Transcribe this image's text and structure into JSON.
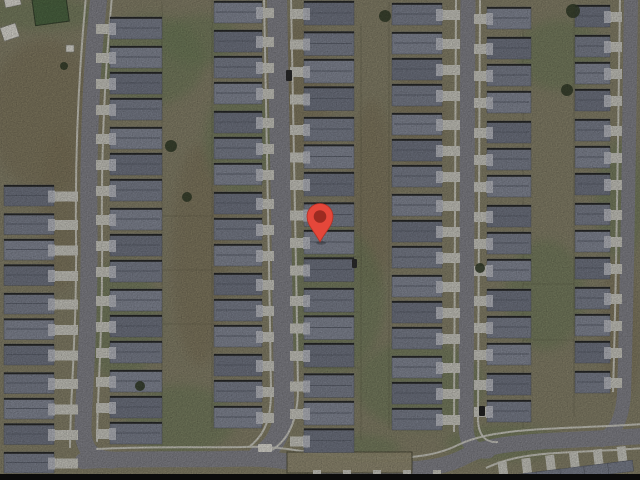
{
  "map": {
    "width": 640,
    "height": 480,
    "palette": {
      "ground": "#8f8a71",
      "dirt": "#867c61",
      "grass": "#75855e",
      "grass_dark": "#4e6b44",
      "road": "#8c8c93",
      "sidewalk": "#deddd4",
      "driveway": "#d7d6cd",
      "roof_shades": [
        "#787d8b",
        "#838896",
        "#8d92a0"
      ],
      "roof_stroke": "#5a5e68",
      "roof_eave": "#1e1e1c",
      "roof_ridge": "#656a77",
      "garage": "#c9cbd1",
      "fence": "#53523d",
      "tree": "#39432e",
      "white": "#eceae2",
      "bottom_bar": "#0b0b0b",
      "marker_fill": "#e5473a",
      "marker_stroke": "#b23226",
      "marker_hole": "#9c2b21"
    },
    "marker": {
      "x": 320,
      "center_y": 216.5,
      "tip_y": 242,
      "radius": 13,
      "hole_radius": 6.3
    },
    "streets": [
      {
        "name": "street-left",
        "width": 17,
        "path": "M 99 -4 C 92 60 88 140 89 225 C 90 320 84 390 83 428 C 83 450 92 459 112 460"
      },
      {
        "name": "street-center",
        "width": 20,
        "path": "M 277 -4 C 280 140 282 260 284 395 C 285 425 278 446 258 456"
      },
      {
        "name": "street-right",
        "width": 15,
        "path": "M 468 -4 L 466 425 C 466 444 474 452 488 451"
      },
      {
        "name": "street-far-right",
        "width": 14,
        "path": "M 631 -4 C 629 150 627 300 624 395 C 622 418 616 432 602 440"
      },
      {
        "name": "street-bottom",
        "width": 16,
        "path": "M 83 461 C 130 458 190 460 225 459 C 258 458 275 459 295 463 C 330 469 365 471 398 470 C 428 469 448 466 466 456 C 488 445 515 443 548 441 C 585 439 615 438 644 436"
      }
    ],
    "sidewalks": [
      "M 86 -4 C 79 70 75 150 76 235 C 77 330 70 400 70 448",
      "M 112 -4 C 105 70 101 150 102 235 C 103 330 97 400 97 442",
      "M 264 -4 C 267 140 269 260 271 392 C 271 416 266 434 250 446",
      "M 291 -4 C 294 140 296 260 298 388 C 298 416 291 438 272 450",
      "M 456 -4 L 454 432",
      "M 480 -4 L 478 418 C 478 436 486 443 498 442",
      "M 620 -4 C 618 150 616 300 613 392",
      "M 96 449 C 150 446 205 448 242 447 C 272 446 288 449 308 452 C 338 457 368 459 396 458 C 420 457 440 454 458 445 C 478 435 508 431 544 429 C 584 427 614 426 644 424",
      "M 486 468 C 505 459 525 455 556 453 C 592 451 620 450 644 448"
    ],
    "house_columns": [
      {
        "x": 4,
        "w": 52,
        "h": 21,
        "y0": 186,
        "step": 26.5,
        "count": 11,
        "side": "right",
        "drive_len": 24
      },
      {
        "x": 110,
        "w": 52,
        "h": 22,
        "y0": 18,
        "step": 27,
        "count": 16,
        "side": "left",
        "drive_len": 14
      },
      {
        "x": 214,
        "w": 46,
        "h": 22,
        "y0": 2,
        "step": 27,
        "count": 16,
        "side": "right",
        "drive_len": 12
      },
      {
        "x": 304,
        "w": 52,
        "h": 24,
        "y0": 2,
        "step": 28.5,
        "count": 16,
        "side": "left",
        "drive_len": 14
      },
      {
        "x": 392,
        "w": 50,
        "h": 22,
        "y0": 4,
        "step": 27,
        "count": 16,
        "side": "right",
        "drive_len": 18
      },
      {
        "x": 487,
        "w": 42,
        "h": 22,
        "y0": 8,
        "step": 28,
        "count": 15,
        "side": "left",
        "drive_len": 13
      },
      {
        "x": 575,
        "w": 37,
        "h": 22,
        "y0": 6,
        "step": 28,
        "count": 14,
        "side": "right",
        "drive_len": 12
      }
    ],
    "grass_patches": [
      [
        40,
        14,
        60,
        16
      ],
      [
        150,
        60,
        55,
        45
      ],
      [
        240,
        140,
        35,
        55
      ],
      [
        330,
        300,
        55,
        75
      ],
      [
        420,
        385,
        65,
        45
      ],
      [
        545,
        295,
        40,
        55
      ],
      [
        560,
        55,
        45,
        35
      ],
      [
        180,
        420,
        55,
        35
      ],
      [
        505,
        443,
        60,
        18
      ],
      [
        355,
        448,
        45,
        14
      ],
      [
        120,
        320,
        40,
        60
      ],
      [
        620,
        200,
        25,
        60
      ],
      [
        200,
        40,
        40,
        25
      ]
    ],
    "dirt_patches": [
      [
        45,
        115,
        55,
        75
      ],
      [
        200,
        255,
        28,
        110
      ],
      [
        372,
        195,
        22,
        95
      ],
      [
        300,
        90,
        30,
        70
      ],
      [
        620,
        330,
        20,
        70
      ],
      [
        60,
        210,
        20,
        80
      ],
      [
        420,
        120,
        25,
        60
      ]
    ],
    "fences_v": [
      [
        162,
        2,
        162,
        448
      ],
      [
        212,
        0,
        212,
        432
      ],
      [
        361,
        24,
        361,
        440
      ],
      [
        389,
        2,
        389,
        430
      ],
      [
        523,
        6,
        523,
        428
      ],
      [
        574,
        4,
        574,
        416
      ]
    ],
    "fences_h": [
      [
        160,
        216,
        214,
        216
      ],
      [
        160,
        270,
        214,
        270
      ],
      [
        160,
        324,
        214,
        324
      ],
      [
        305,
        257,
        360,
        257
      ],
      [
        305,
        312,
        360,
        312
      ],
      [
        305,
        368,
        360,
        368
      ],
      [
        523,
        284,
        574,
        284
      ],
      [
        523,
        340,
        574,
        340
      ],
      [
        390,
        260,
        440,
        260
      ],
      [
        390,
        368,
        440,
        368
      ]
    ],
    "green_square": {
      "x": 32,
      "y": 0,
      "w": 34,
      "h": 26
    },
    "sheds": [
      {
        "x": 4,
        "y": 0,
        "w": 16,
        "h": 8,
        "rot": -12
      },
      {
        "x": 0,
        "y": 28,
        "w": 16,
        "h": 14,
        "rot": -18
      },
      {
        "x": 66,
        "y": 45,
        "w": 8,
        "h": 7,
        "rot": 0
      }
    ],
    "yard_island": {
      "x": 287,
      "y": 452,
      "w": 125,
      "h": 21
    },
    "trees": [
      [
        385,
        16,
        6
      ],
      [
        573,
        11,
        7
      ],
      [
        567,
        90,
        6
      ],
      [
        480,
        268,
        5
      ],
      [
        171,
        146,
        6
      ],
      [
        140,
        386,
        5
      ],
      [
        64,
        66,
        4
      ],
      [
        187,
        197,
        5
      ]
    ],
    "vehicles": [
      {
        "x": 286,
        "y": 70,
        "w": 6,
        "h": 11,
        "c": "#2e2e2e"
      },
      {
        "x": 479,
        "y": 406,
        "w": 6,
        "h": 10,
        "c": "#262626"
      },
      {
        "x": 258,
        "y": 444,
        "w": 14,
        "h": 8,
        "c": "#eceae2"
      },
      {
        "x": 352,
        "y": 259,
        "w": 5,
        "h": 9,
        "c": "#303030"
      }
    ],
    "bottom_right_row": {
      "rot": -7,
      "cx": 560,
      "cy": 462,
      "x0": 498,
      "x1": 640,
      "step": 24,
      "stub_y": 454,
      "stub_w": 9,
      "stub_h": 16,
      "roof_dy": 15,
      "roof_w": 25,
      "roof_h": 11
    },
    "bottom_center_stubs": [
      313,
      343,
      373,
      403,
      433
    ],
    "bottom_bar_y": 474
  }
}
